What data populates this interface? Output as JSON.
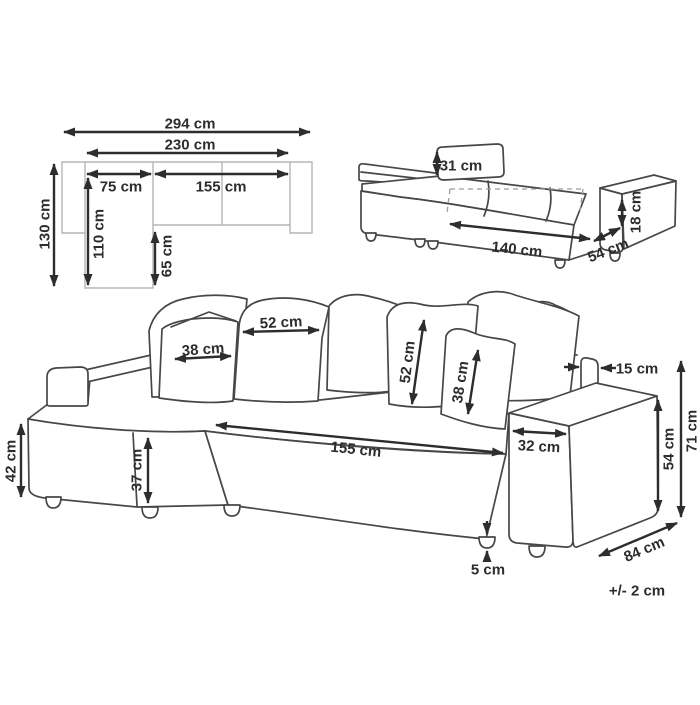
{
  "colors": {
    "background": "#ffffff",
    "ink": "#2d2d2d",
    "sketch_line": "#474747",
    "plan_line": "#b5b5b5"
  },
  "unit": "cm",
  "plan_view": {
    "total_width": "294 cm",
    "inner_width": "230 cm",
    "chaise_width": "75 cm",
    "seat_length": "155 cm",
    "total_depth": "130 cm",
    "chaise_length": "110 cm",
    "chaise_protrusion": "65 cm"
  },
  "bed_view": {
    "backrest_cushion_height": "31 cm",
    "sleeping_width": "140 cm",
    "extension_depth": "54 cm",
    "platform_height": "18 cm"
  },
  "front_view": {
    "large_pillow_width": "52 cm",
    "small_pillow_width": "38 cm",
    "large_pillow_height": "52 cm",
    "small_pillow_height": "38 cm",
    "backrest_thickness": "15 cm",
    "seat_front_width": "155 cm",
    "armrest_width": "32 cm",
    "armrest_height": "54 cm",
    "overall_height": "71 cm",
    "seat_height": "42 cm",
    "chaise_front_height": "37 cm",
    "leg_height": "5 cm",
    "depth": "84 cm"
  },
  "tolerance_note": "+/- 2 cm"
}
